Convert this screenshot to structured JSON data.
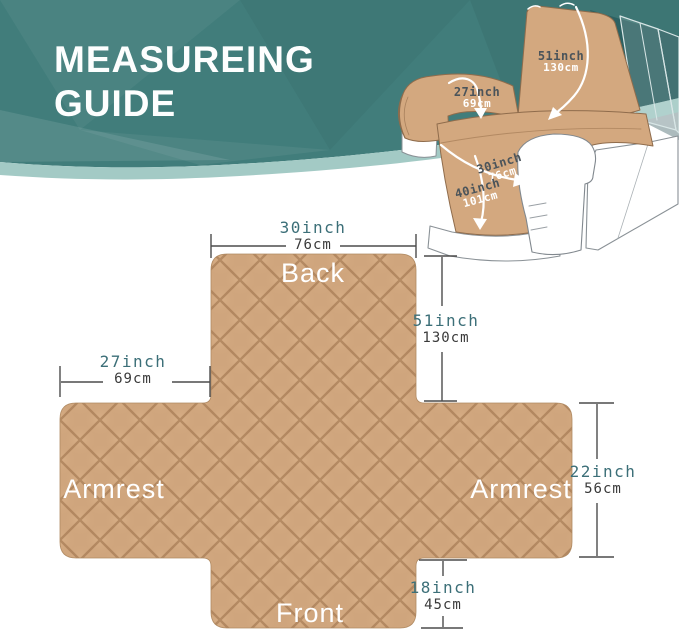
{
  "header": {
    "title_line1": "MEASUREING",
    "title_line2": "GUIDE"
  },
  "chair": {
    "labels": [
      {
        "name": "back-height",
        "inch": "51inch",
        "cm": "130cm"
      },
      {
        "name": "armrest",
        "inch": "27inch",
        "cm": "69cm"
      },
      {
        "name": "seat-width",
        "inch": "30inch",
        "cm": "76cm"
      },
      {
        "name": "seat-length",
        "inch": "40inch",
        "cm": "101cm"
      }
    ]
  },
  "diagram": {
    "areas": {
      "back": "Back",
      "armrest_left": "Armrest",
      "armrest_right": "Armrest",
      "front": "Front"
    },
    "dimensions": {
      "top": {
        "inch": "30inch",
        "cm": "76cm"
      },
      "back_side": {
        "inch": "51inch",
        "cm": "130cm"
      },
      "left_arm": {
        "inch": "27inch",
        "cm": "69cm"
      },
      "right_arm": {
        "inch": "22inch",
        "cm": "56cm"
      },
      "bottom": {
        "inch": "18inch",
        "cm": "45cm"
      }
    }
  },
  "colors": {
    "banner_teal": "#417d7b",
    "banner_light_band": "#a3cac5",
    "cover_tan": "#cfa57d",
    "quilt_line": "#946742",
    "dim_inch_text": "#3c6f78",
    "dim_cm_text": "#3a3a3a",
    "area_text": "#ffffff",
    "dimension_line": "#4c4c4c"
  }
}
